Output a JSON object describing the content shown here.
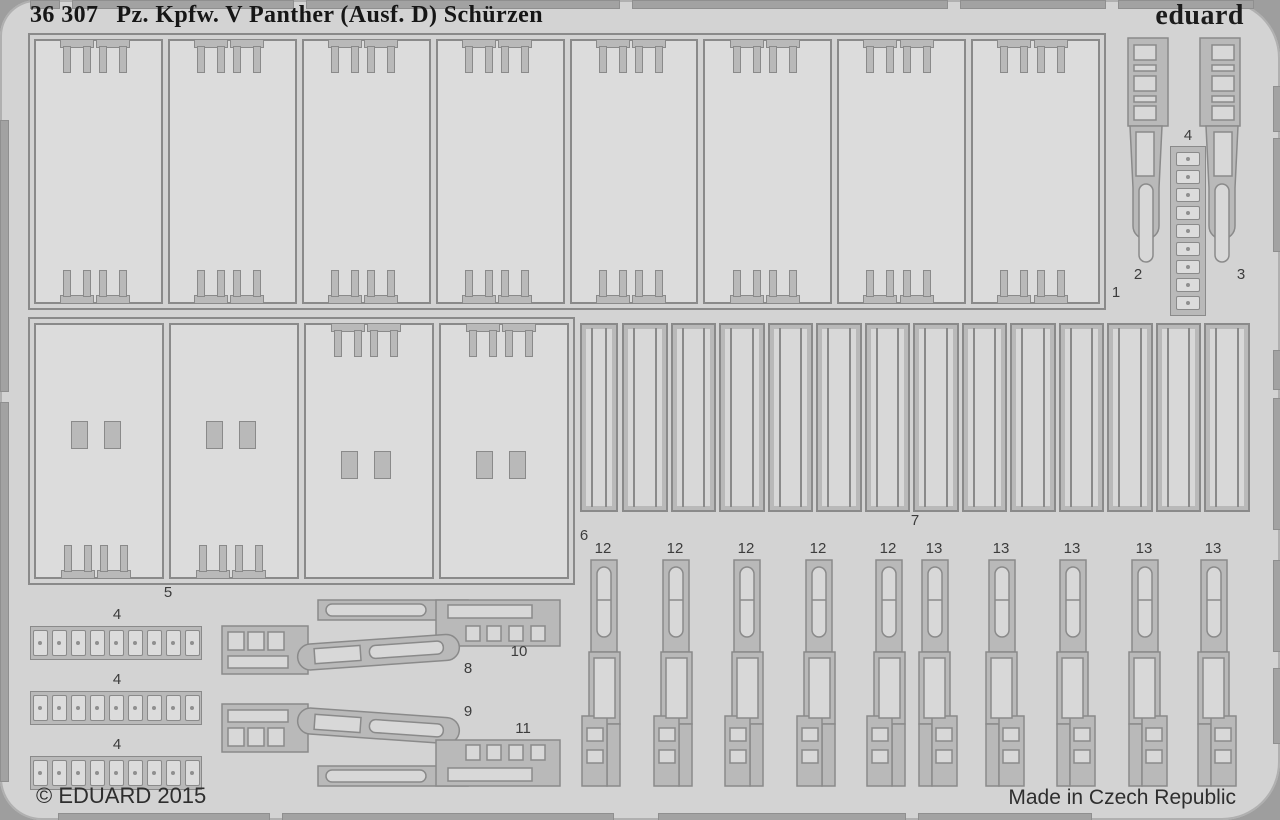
{
  "header": {
    "code": "36 307",
    "title": "Pz. Kpfw. V Panther (Ausf. D) Schürzen",
    "brand": "eduard"
  },
  "footer": {
    "copyright": "© EDUARD 2015",
    "origin": "Made in Czech Republic"
  },
  "part_labels": {
    "p1": "1",
    "p2": "2",
    "p3": "3",
    "p4": "4",
    "p5": "5",
    "p6": "6",
    "p7": "7",
    "p8": "8",
    "p9": "9",
    "p10": "10",
    "p11": "11",
    "p12": "12",
    "p13": "13"
  },
  "quantities": {
    "part1_panels": 8,
    "part4_strips": 3,
    "part4_items_per_strip": 9,
    "part5_panels": 4,
    "part7_modules": 13,
    "part12_count": 5,
    "part13_count": 5
  },
  "colors": {
    "backdrop": "#9e9e9e",
    "sheet": "#d3d3d3",
    "etch_line": "#8a8a8a",
    "half_etch": "#b9b9b9",
    "part_interior": "#dcdcdc",
    "title_text": "#161616",
    "label_text": "#3c3c3c",
    "footer_text": "#2e2e2e"
  }
}
